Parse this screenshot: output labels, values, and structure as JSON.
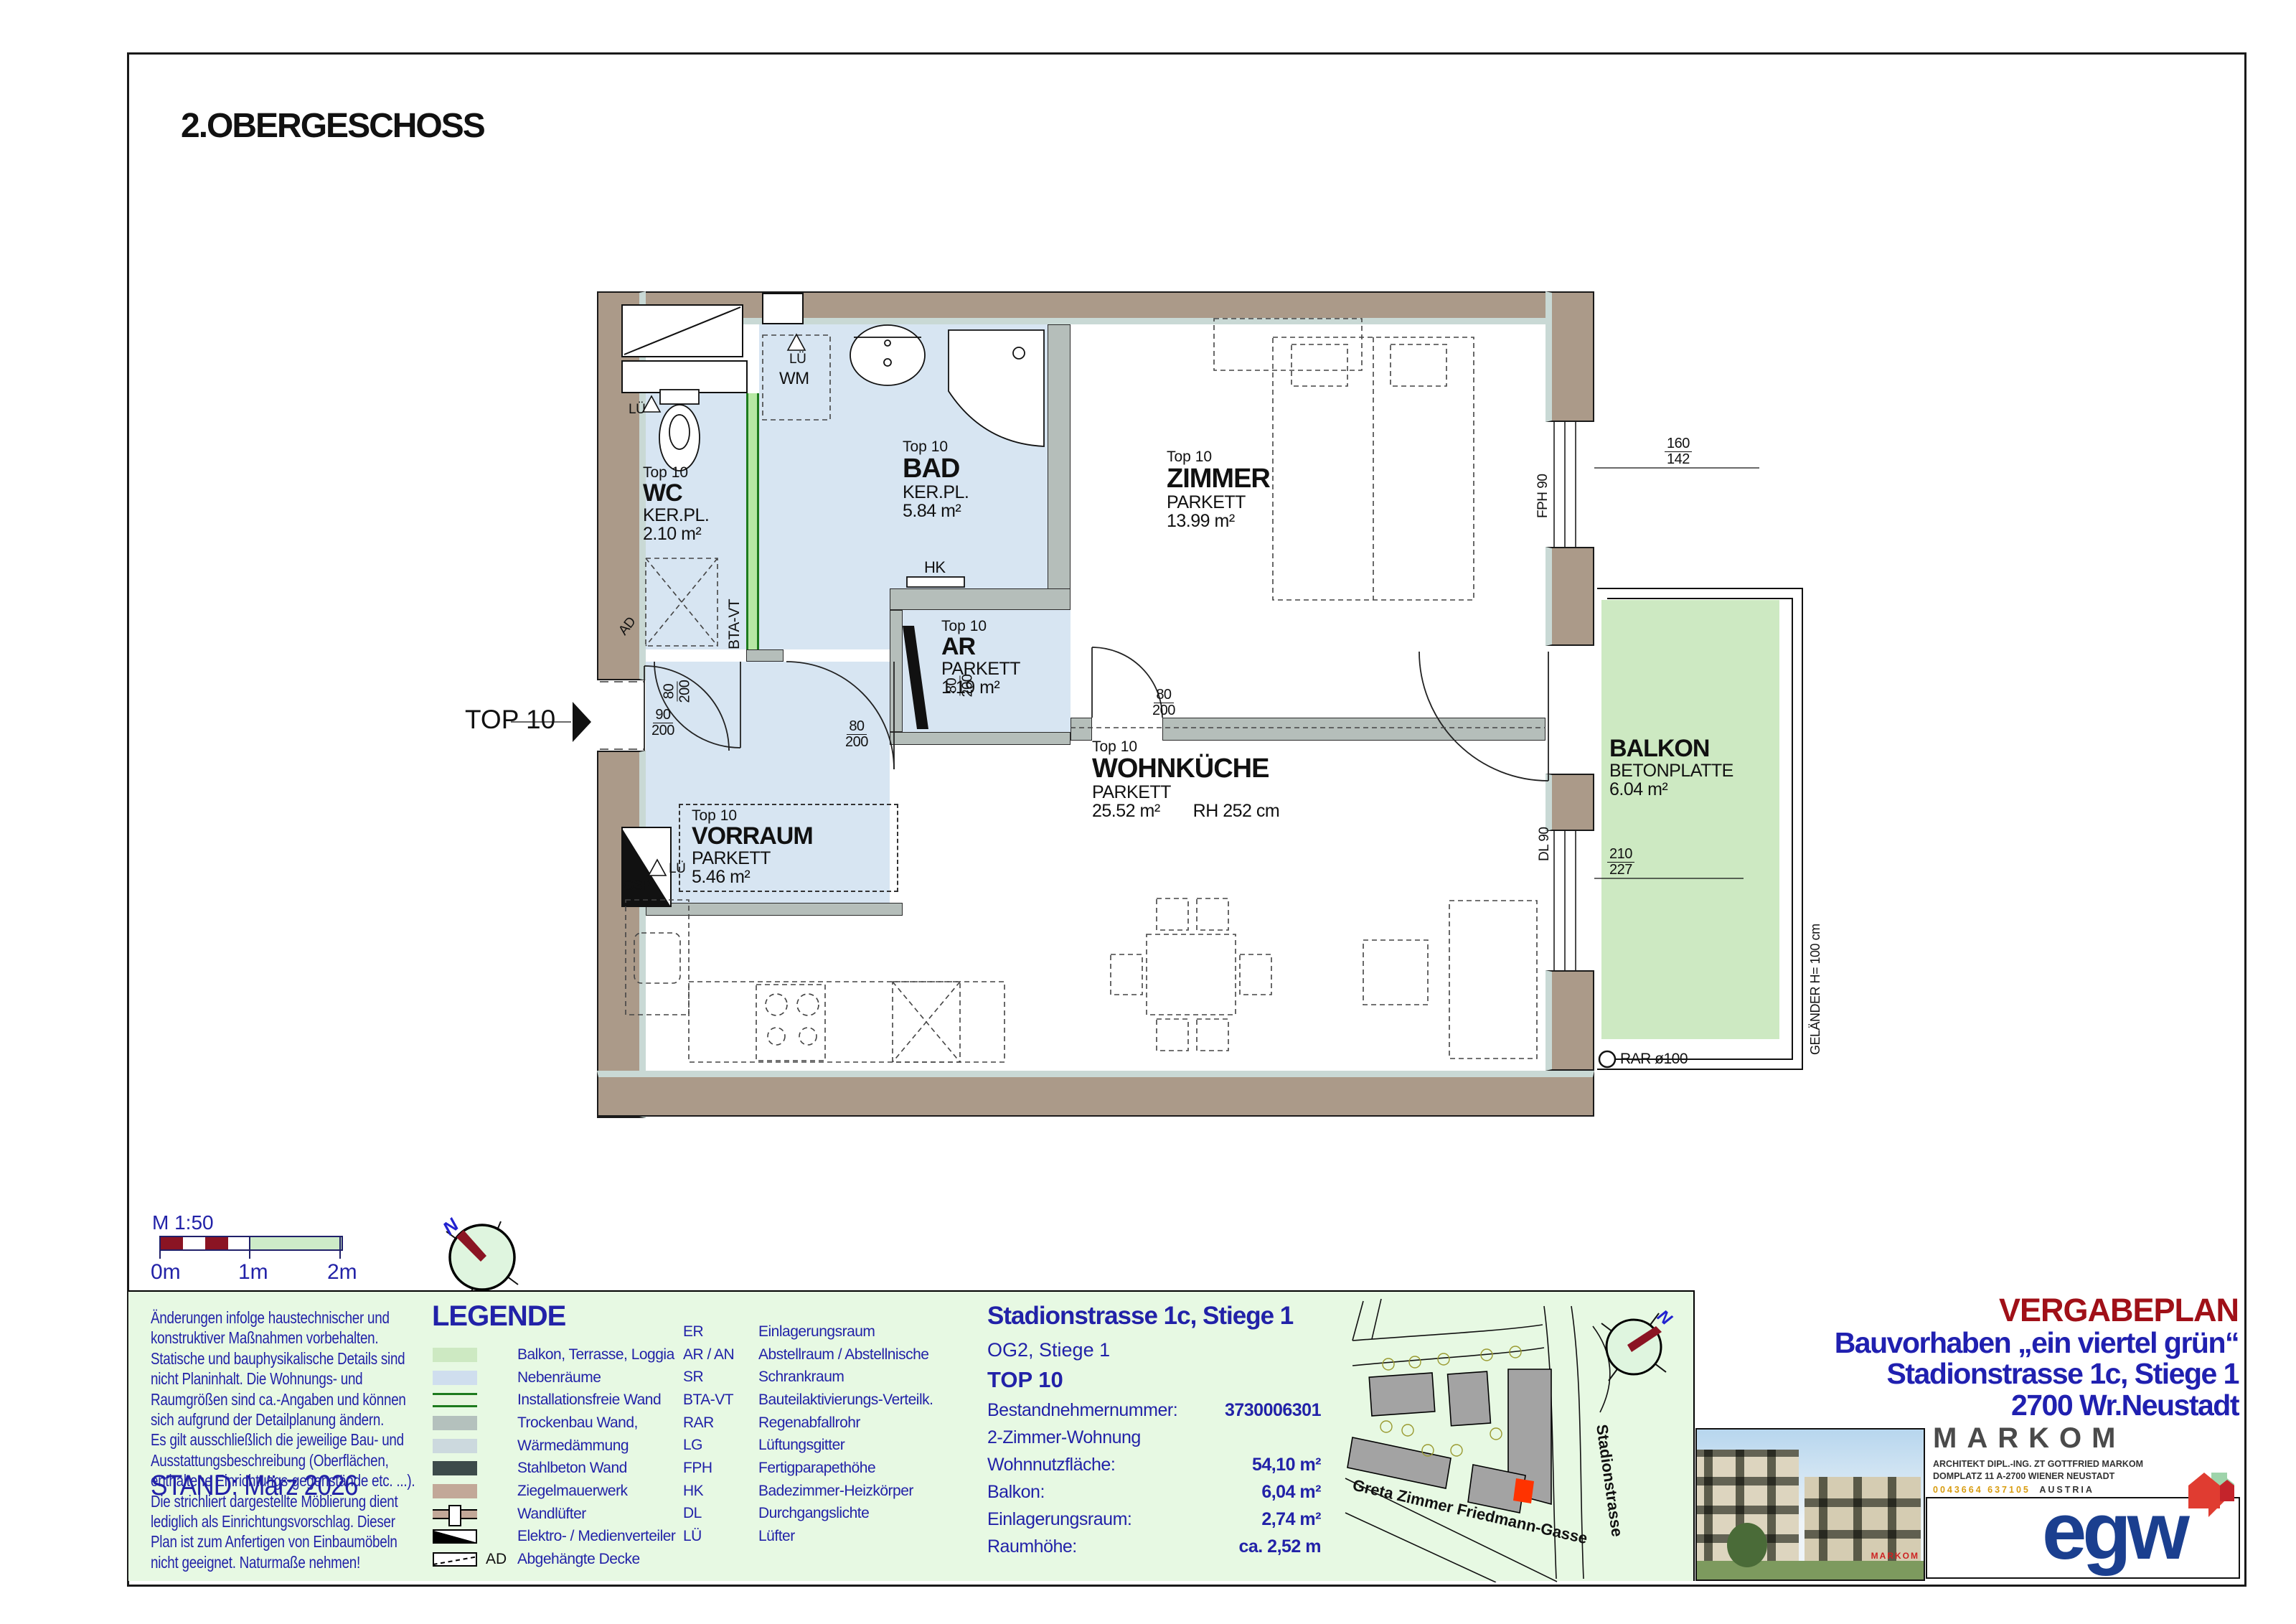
{
  "colors": {
    "navy": "#2222a8",
    "dark_red": "#a01018",
    "balcony_green": "#cde9c2",
    "room_blue": "#d7e5f2",
    "band_green": "#e7f9e3",
    "wall_brown": "#ab9a89",
    "marker_red": "#ff3300",
    "egw_blue": "#1b3f8f"
  },
  "page": {
    "title": "2.OBERGESCHOSS"
  },
  "plan": {
    "entry": "TOP 10",
    "rooms": {
      "wc": {
        "t": "Top 10",
        "n": "WC",
        "f": "KER.PL.",
        "a": "2.10 m²"
      },
      "bad": {
        "t": "Top 10",
        "n": "BAD",
        "f": "KER.PL.",
        "a": "5.84 m²"
      },
      "ar": {
        "t": "Top 10",
        "n": "AR",
        "f": "PARKETT",
        "a": "1.19 m²"
      },
      "zimmer": {
        "t": "Top 10",
        "n": "ZIMMER",
        "f": "PARKETT",
        "a": "13.99 m²"
      },
      "wk": {
        "t": "Top 10",
        "n": "WOHNKÜCHE",
        "f": "PARKETT",
        "a": "25.52 m²",
        "rh": "RH 252 cm"
      },
      "vorraum": {
        "t": "Top 10",
        "n": "VORRAUM",
        "f": "PARKETT",
        "a": "5.46 m²"
      },
      "balkon": {
        "n": "BALKON",
        "f": "BETONPLATTE",
        "a": "6.04 m²"
      }
    },
    "ann": {
      "wm": "WM",
      "hk": "HK",
      "gsp": "GSP",
      "lue": "LÜ",
      "ad": "AD",
      "btavt": "BTA-VT",
      "fph": "FPH 90",
      "dl": "DL 90",
      "gelaender": "GELÄNDER H= 100 cm",
      "rar": "RAR ø100"
    },
    "dims": {
      "entry": {
        "top": "90",
        "bot": "200"
      },
      "door": {
        "top": "80",
        "bot": "200"
      },
      "window_zimmer": {
        "top": "160",
        "bot": "142"
      },
      "window_balkon": {
        "top": "210",
        "bot": "227"
      }
    }
  },
  "scale": {
    "label": "M 1:50",
    "t0": "0m",
    "t1": "1m",
    "t2": "2m"
  },
  "compass": {
    "n": "N"
  },
  "footer": {
    "disclaimer": "Änderungen infolge haustechnischer und\nkonstruktiver Maßnahmen vorbehalten.\nStatische und bauphysikalische Details sind\nnicht Planinhalt. Die Wohnungs- und\nRaumgrößen sind ca.-Angaben und können\nsich aufgrund der Detailplanung ändern.\nEs gilt ausschließlich die jeweilige Bau- und\nAusstattungsbeschreibung (Oberflächen,\nenthaltene Einrichtungs-gegenstände etc. ...).\nDie strichliert dargestellte Möblierung dient\nlediglich als Einrichtungsvorschlag. Dieser\nPlan ist zum Anfertigen von Einbaumöbeln\nnicht geeignet. Naturmaße nehmen!",
    "stand": "STAND: März 2026",
    "legend": {
      "title": "LEGENDE",
      "ad_tag": "AD",
      "items": [
        "Balkon, Terrasse, Loggia",
        "Nebenräume",
        "Installationsfreie Wand",
        "Trockenbau Wand,",
        "Wärmedämmung",
        "Stahlbeton Wand",
        "Ziegelmauerwerk",
        "Wandlüfter",
        "Elektro- / Medienverteiler",
        "Abgehängte Decke"
      ],
      "abbr": [
        {
          "k": "ER",
          "v": "Einlagerungsraum"
        },
        {
          "k": "AR / AN",
          "v": "Abstellraum / Abstellnische"
        },
        {
          "k": "SR",
          "v": "Schrankraum"
        },
        {
          "k": "BTA-VT",
          "v": "Bauteilaktivierungs-Verteilk."
        },
        {
          "k": "RAR",
          "v": "Regenabfallrohr"
        },
        {
          "k": "LG",
          "v": "Lüftungsgitter"
        },
        {
          "k": "FPH",
          "v": "Fertigparapethöhe"
        },
        {
          "k": "HK",
          "v": "Badezimmer-Heizkörper"
        },
        {
          "k": "DL",
          "v": "Durchgangslichte"
        },
        {
          "k": "LÜ",
          "v": "Lüfter"
        }
      ]
    },
    "info": {
      "title": "Stadionstrasse 1c, Stiege 1",
      "sub": "OG2, Stiege 1",
      "top": "TOP 10",
      "rows": [
        {
          "l": "Bestandnehmernummer:",
          "v": "3730006301"
        },
        {
          "l": "2-Zimmer-Wohnung",
          "v": ""
        },
        {
          "l": "Wohnnutzfläche:",
          "v": "54,10 m²"
        },
        {
          "l": "Balkon:",
          "v": "6,04 m²"
        },
        {
          "l": "Einlagerungsraum:",
          "v": "2,74 m²"
        },
        {
          "l": "Raumhöhe:",
          "v": "ca. 2,52 m"
        }
      ]
    },
    "map": {
      "street1": "Greta Zimmer Friedmann-Gasse",
      "street2": "Stadionstrasse"
    },
    "titleblock": {
      "type": "VERGABEPLAN",
      "project": "Bauvorhaben „ein viertel grün“",
      "address": "Stadionstrasse 1c, Stiege 1",
      "city": "2700 Wr.Neustadt"
    },
    "markom": {
      "name": "MARKOM",
      "l1": "ARCHITEKT DIPL.-ING. ZT GOTTFRIED MARKOM",
      "l2": "DOMPLATZ 11  A-2700 WIENER NEUSTADT",
      "phone": "0043664 637105",
      "country": "AUSTRIA",
      "web": "W W W . M A R K O M . C C",
      "wm": "MARKOM"
    },
    "egw": {
      "logo": "egw"
    }
  }
}
